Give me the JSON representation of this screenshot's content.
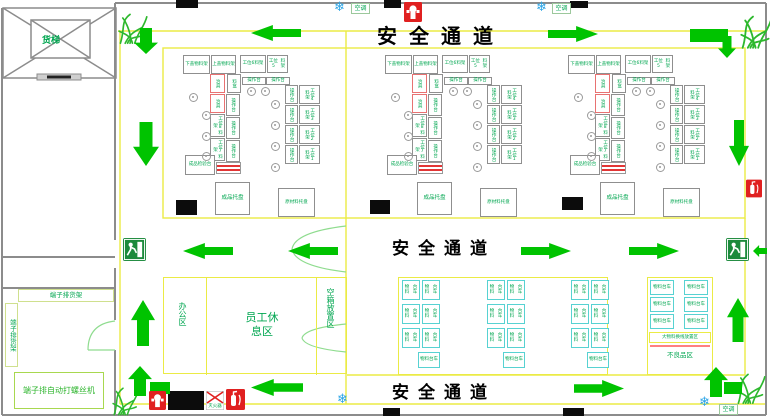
{
  "corridor_label": "安全通道",
  "elevator": {
    "label": "货梯"
  },
  "left_rooms": {
    "rack_top_label": "端子排货架",
    "rack_side_label": "端子排货架",
    "machine_label": "端子排自动打螺丝机"
  },
  "office": {
    "office_label": "办公区",
    "rest_label_1": "员工休",
    "rest_label_2": "息区",
    "empty_box_label": "空箱放置区"
  },
  "cell": {
    "top_boxes": [
      {
        "l1": "下盖物",
        "l2": "料架"
      },
      {
        "l1": "上盖物",
        "l2": "料架"
      },
      {
        "l1": "工位6",
        "l2": "料架"
      },
      {
        "l1": "工位5",
        "l2": "料架"
      }
    ],
    "desk_label": "操作台",
    "tool_box_label": "治具",
    "bin_label": "料盒",
    "left_arm_op": "操作台",
    "left_arm_racks": [
      "工位8料架",
      "工位7料架"
    ],
    "right_arm_rows": [
      {
        "op": "操作台",
        "rack": "工位4料架"
      },
      {
        "op": "操作台",
        "rack": "工位3料架"
      },
      {
        "op": "操作台",
        "rack": "工位2料架"
      },
      {
        "op": "操作台",
        "rack": "工位1料架"
      }
    ],
    "inspection_1": "成品检",
    "inspection_2": "验台",
    "pallet_finished": "成品托盘",
    "pallet_raw_1": "原材料",
    "pallet_raw_2": "托盘"
  },
  "trolleys": {
    "line1": "物料",
    "line2": "台车"
  },
  "right_zone": {
    "changeover_label": "大物料换线放置区",
    "defect_label": "不良品区"
  },
  "hvac_label": "空调",
  "fire": {
    "extinguisher_sign": "灭火器"
  },
  "icons": {
    "exit": "safety-exit-sign",
    "hydrant": "fire-hydrant-icon",
    "extinguisher": "fire-extinguisher-icon",
    "snowflake": "air-conditioner-snowflake-icon",
    "plant": "plant-icon",
    "arrow": "flow-arrow-icon"
  },
  "colors": {
    "arrow_green": "#00c300",
    "label_green": "#00a650",
    "marking_yellow": "#ebeb45",
    "trolley_cyan": "#57d2d2",
    "alert_red": "#e23535",
    "ac_blue": "#2aa4e6",
    "wall_gray": "#8c8c8c"
  }
}
